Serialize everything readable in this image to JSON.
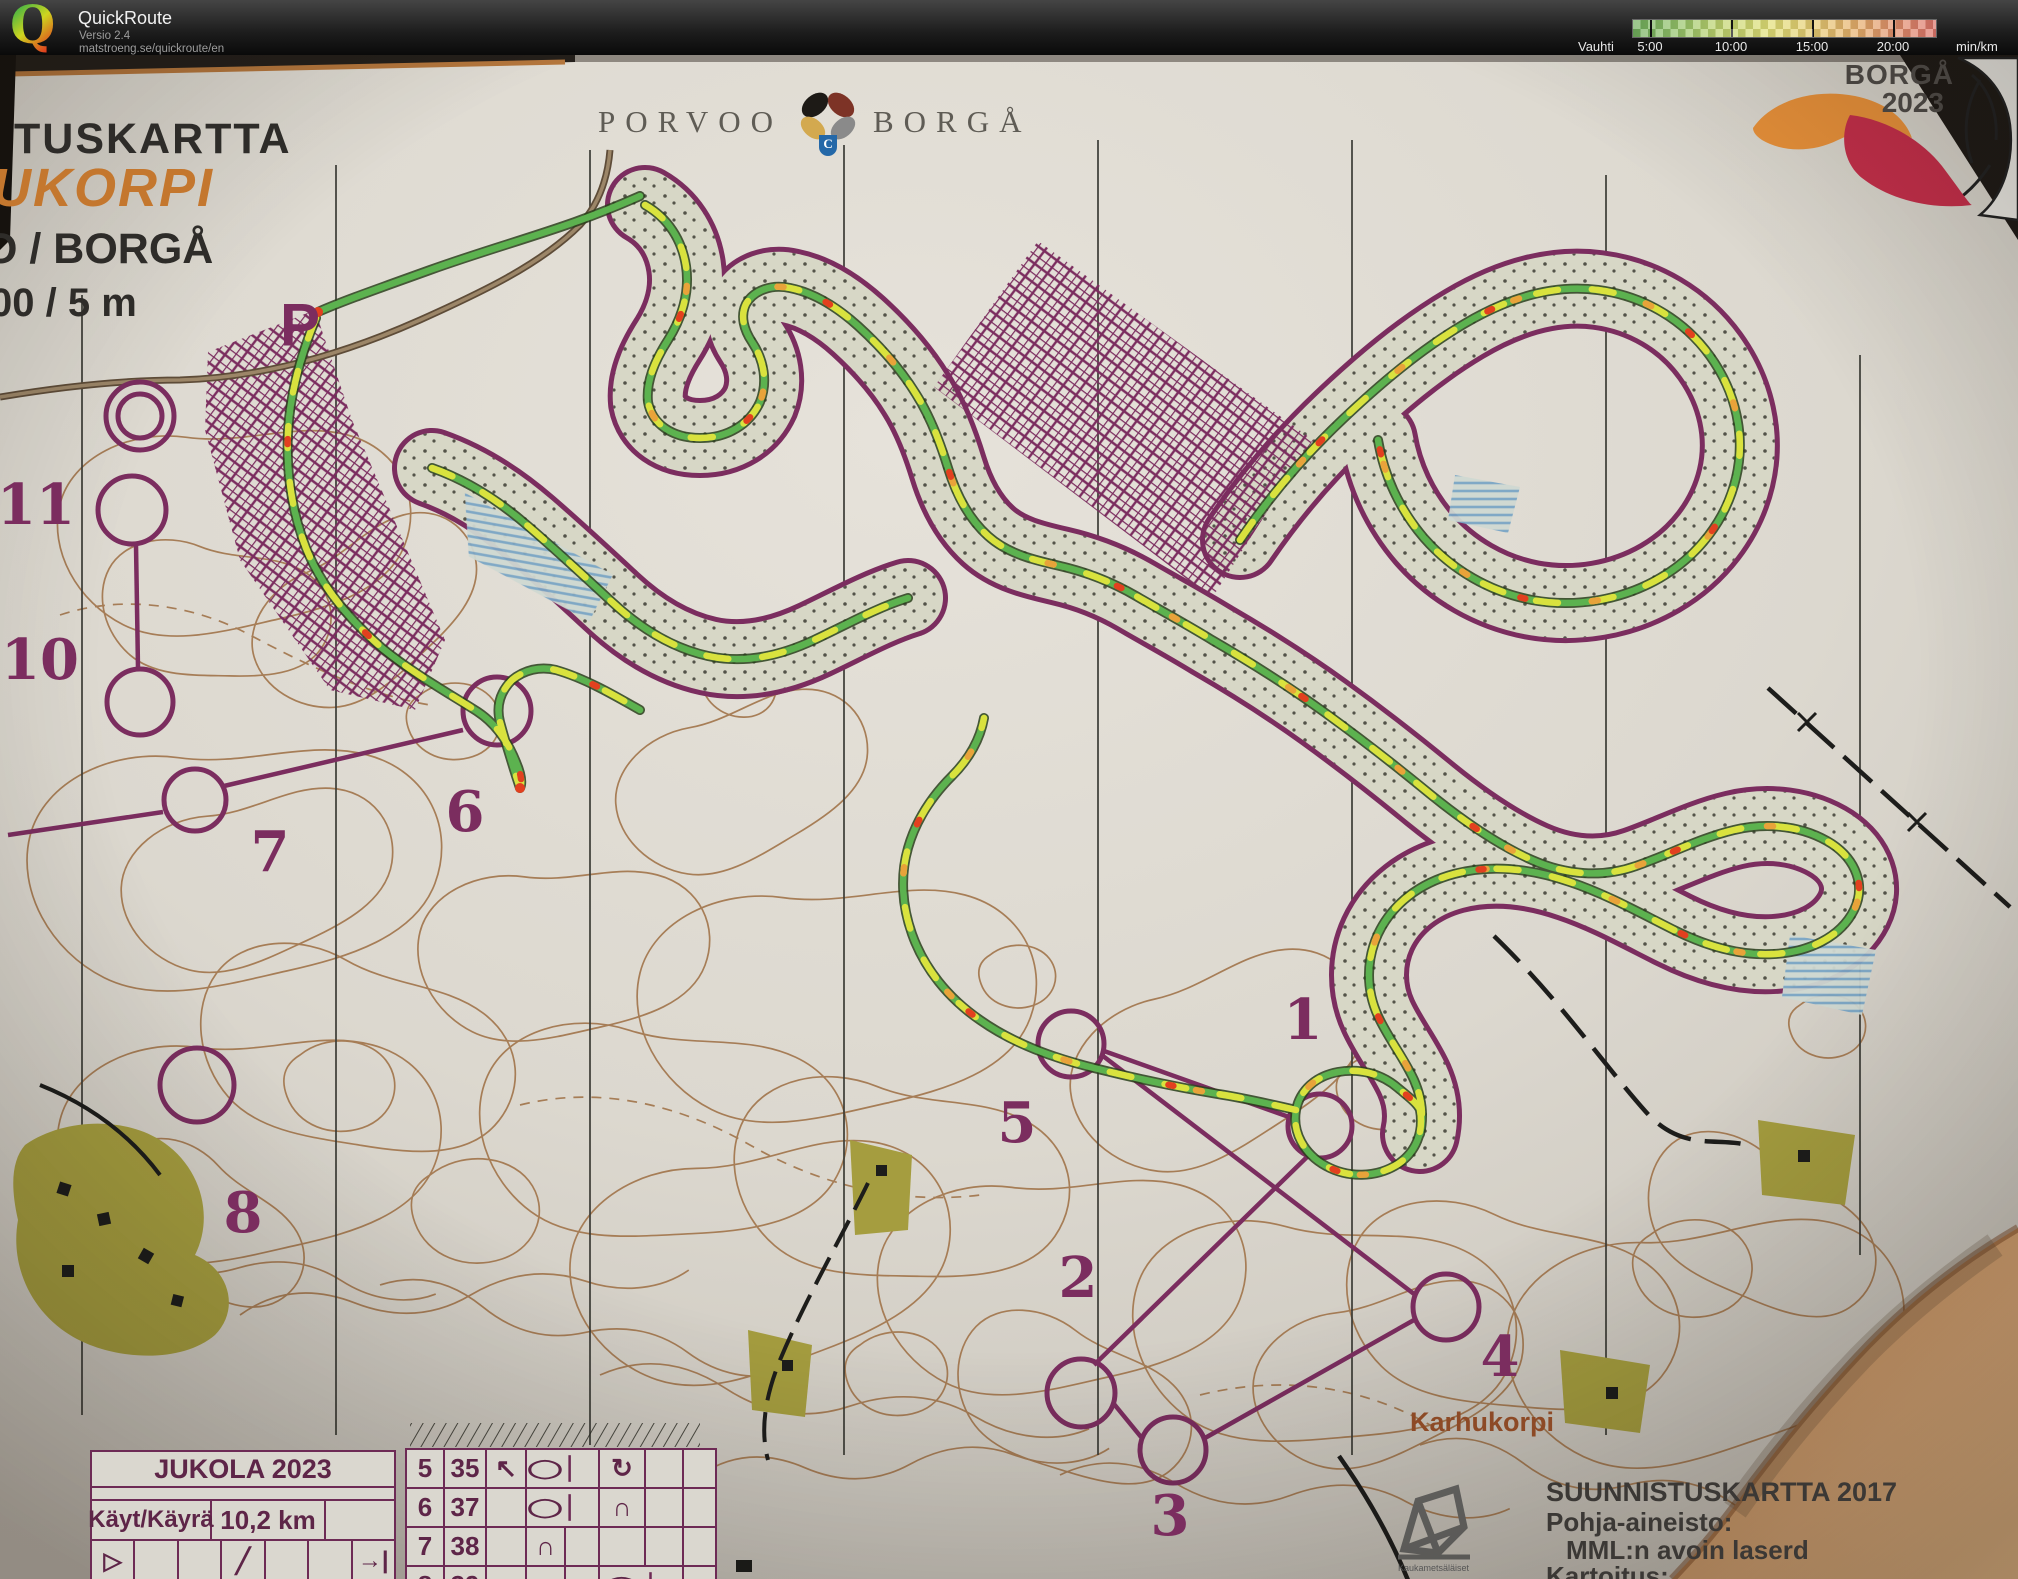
{
  "header": {
    "logo_letter": "Q",
    "app_title": "QuickRoute",
    "version": "Versio 2.4",
    "url": "matstroeng.se/quickroute/en",
    "pace": {
      "label": "Vauhti",
      "unit": "min/km",
      "ticks": [
        "5:00",
        "10:00",
        "15:00",
        "20:00"
      ],
      "gradient": [
        "#6fae5c",
        "#bed46e",
        "#e2e077",
        "#e6ae6a",
        "#dd746a"
      ]
    }
  },
  "map": {
    "title_block": {
      "line1": "TUSKARTTA",
      "line2": "UKORPI",
      "line3": "O / BORGÅ",
      "line4": "00 / 5 m"
    },
    "municipality_logo": {
      "left": "PORVOO",
      "right": "BORGÅ",
      "shield_letter": "C"
    },
    "event_logo": {
      "line1": "BORGÅ",
      "line2": "2023"
    },
    "place_label": "Karhukorpi",
    "start_label": "P",
    "controls": [
      {
        "label": "1"
      },
      {
        "label": "2"
      },
      {
        "label": "3"
      },
      {
        "label": "4"
      },
      {
        "label": "5"
      },
      {
        "label": "6"
      },
      {
        "label": "7"
      },
      {
        "label": "8"
      },
      {
        "label": "10"
      },
      {
        "label": "11"
      }
    ],
    "course_table": {
      "title": "JUKOLA 2023",
      "length_label": "Käyt/Käyrä",
      "length_value": "10,2 km",
      "symbols": [
        "▷",
        "",
        "",
        "╱",
        "",
        "",
        "→|"
      ]
    },
    "control_descriptions": {
      "rows": [
        {
          "num": "5",
          "code": "35",
          "c3": "↖",
          "c4": "◯",
          "c6": "↻"
        },
        {
          "num": "6",
          "code": "37",
          "c3": "",
          "c4": "◯",
          "c6": "∩"
        },
        {
          "num": "7",
          "code": "38",
          "c3": "",
          "c4": "∩",
          "c6": ""
        },
        {
          "num": "8",
          "code": "39",
          "c3": "",
          "c4": "●",
          "c6": "◯"
        }
      ]
    },
    "credits": {
      "line1": "SUUNNISTUSKARTTA 2017",
      "line2": "Pohja-aineisto:",
      "line3": "MML:n avoin laserd",
      "line4": "Kartoitus:",
      "logo_caption": "Kaukametsäläiset"
    },
    "colors": {
      "course_purple": "#7b2d5f",
      "contour_brown": "#a1744a",
      "route_green": "#5cb24f",
      "route_yellow": "#d9e23e",
      "route_red": "#e2401f",
      "paper": "#ded9d0"
    }
  }
}
